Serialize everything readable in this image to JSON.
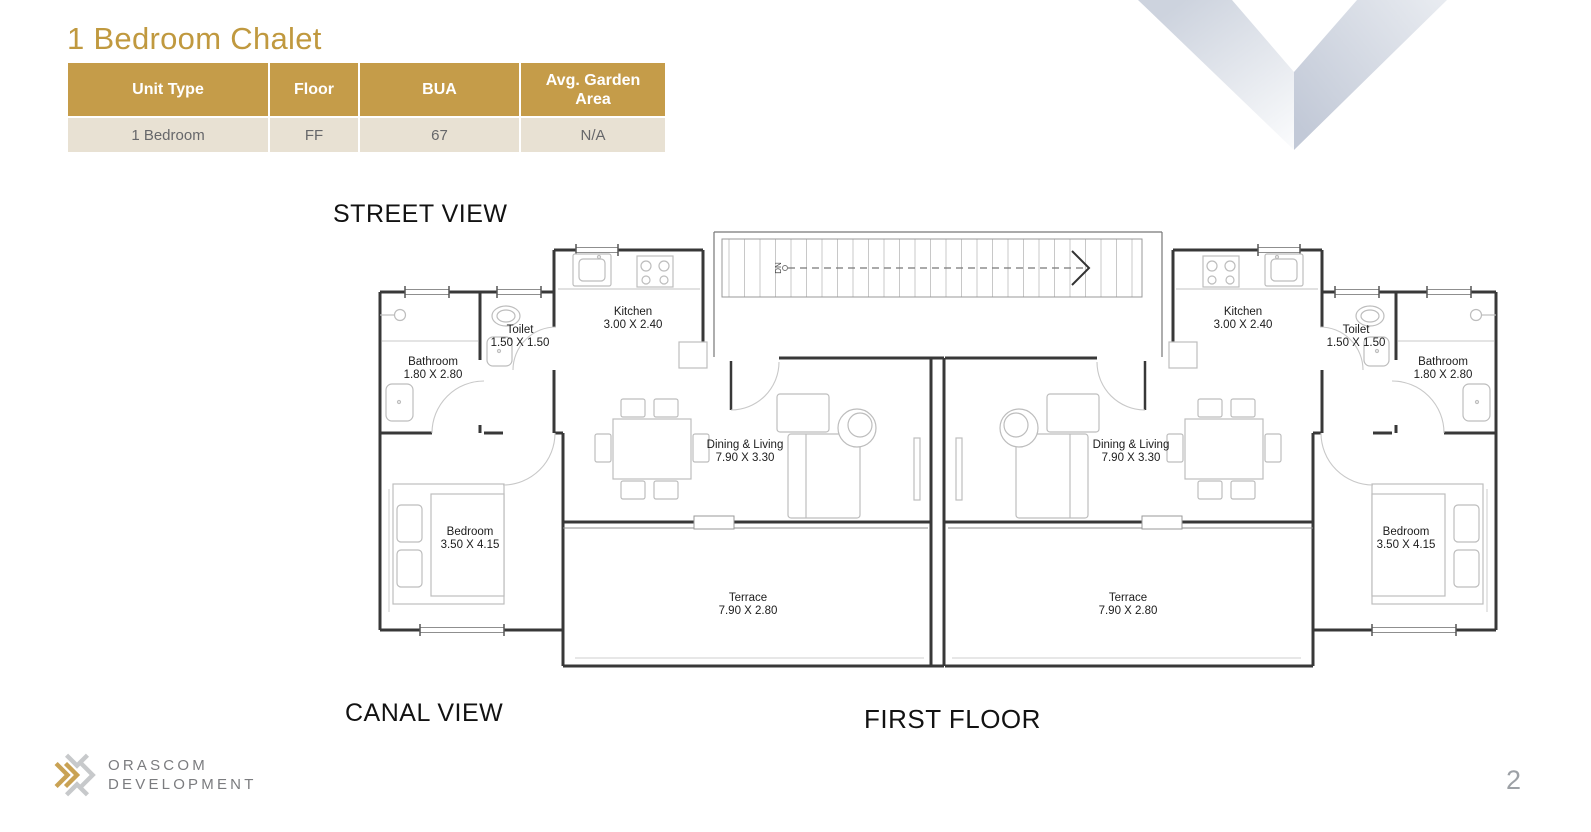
{
  "page": {
    "title": "1 Bedroom Chalet",
    "page_number": "2"
  },
  "unit_table": {
    "headers": [
      "Unit Type",
      "Floor",
      "BUA",
      "Avg. Garden Area"
    ],
    "row": [
      "1 Bedroom",
      "FF",
      "67",
      "N/A"
    ]
  },
  "plan_labels": {
    "street_view": "STREET VIEW",
    "canal_view": "CANAL VIEW",
    "first_floor": "FIRST FLOOR",
    "stairs_down": "DN"
  },
  "rooms": {
    "kitchen": {
      "name": "Kitchen",
      "dims": "3.00 X 2.40"
    },
    "toilet": {
      "name": "Toilet",
      "dims": "1.50 X 1.50"
    },
    "bathroom": {
      "name": "Bathroom",
      "dims": "1.80 X 2.80"
    },
    "bedroom": {
      "name": "Bedroom",
      "dims": "3.50 X 4.15"
    },
    "dining_living": {
      "name": "Dining & Living",
      "dims": "7.90 X 3.30"
    },
    "terrace": {
      "name": "Terrace",
      "dims": "7.90 X 2.80"
    }
  },
  "brand": {
    "line1": "ORASCOM",
    "line2": "DEVELOPMENT"
  },
  "colors": {
    "title_gold": "#C0993F",
    "table_header_bg": "#C59C49",
    "table_row_bg": "#E8E1D3",
    "table_row_text": "#66676A",
    "wall_dark": "#383838",
    "fixture_gray": "#BDBDBD",
    "decor_band_light": "#D5DAE4",
    "decor_band_dark": "#C3CAD8",
    "brand_text_gray": "#7B7C7F",
    "brand_gold": "#C9A254",
    "page_number_gray": "#9DA1A6"
  }
}
